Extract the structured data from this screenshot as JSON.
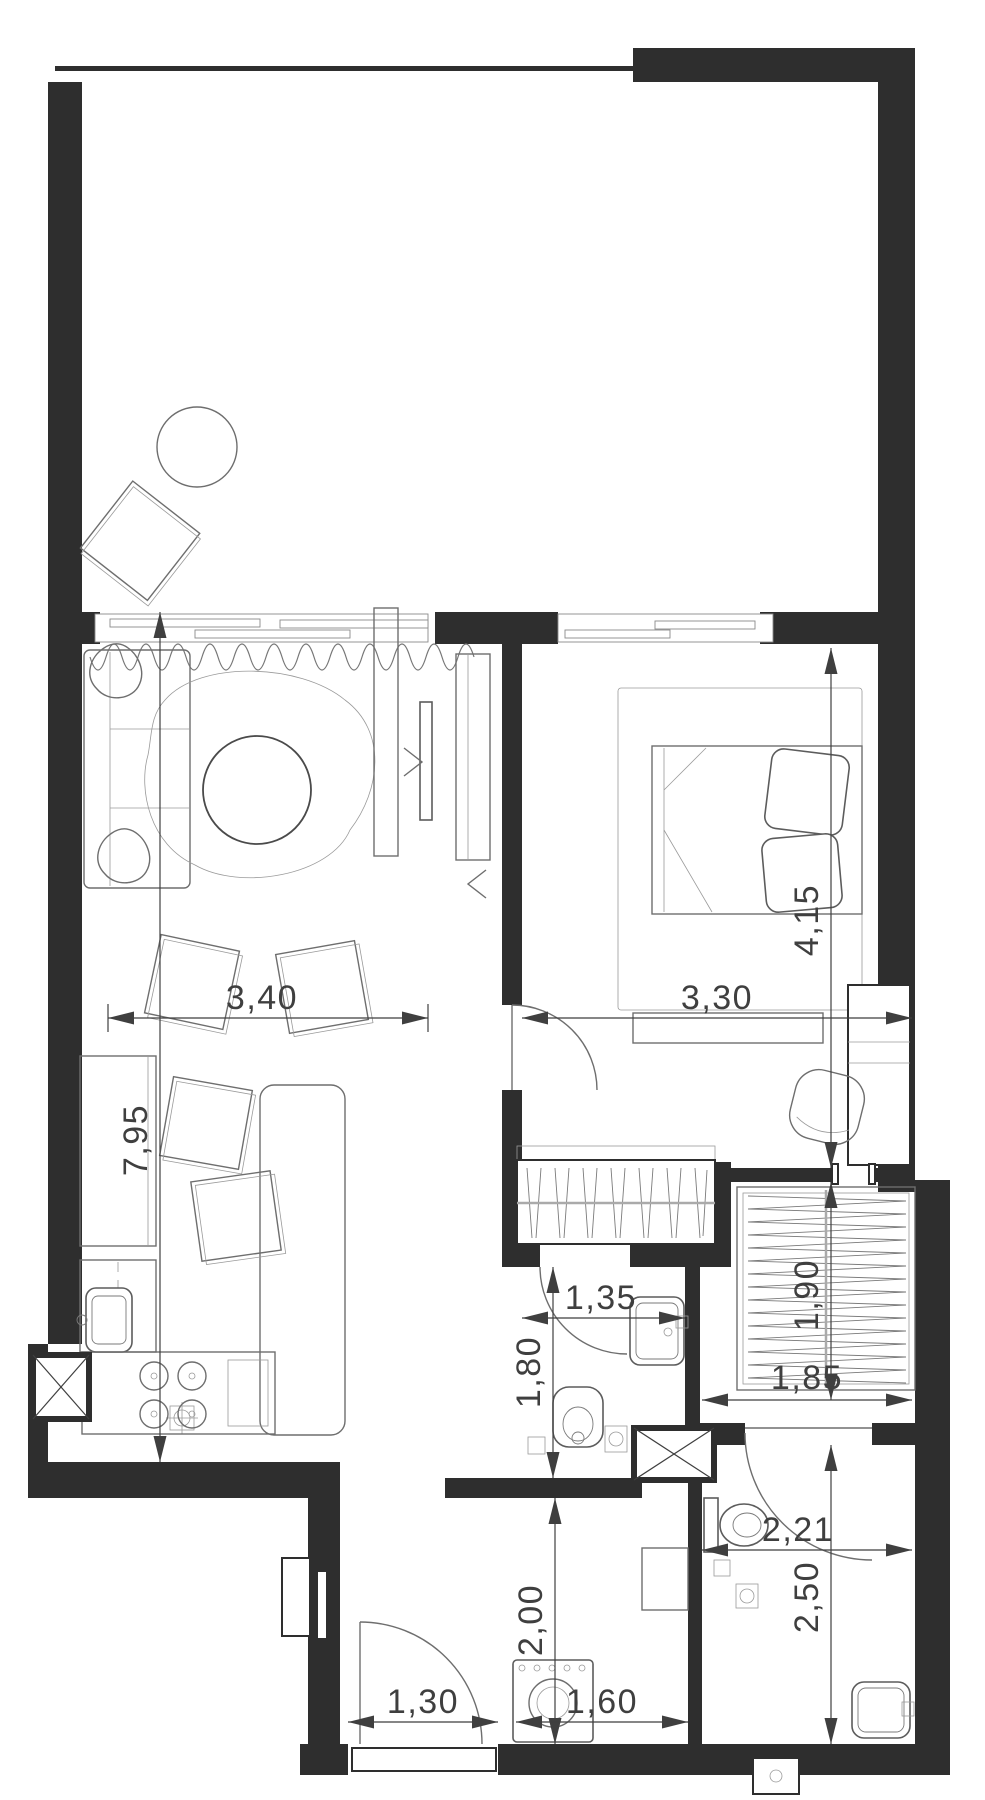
{
  "plan": {
    "type": "apartment-floor-plan",
    "dimensions": {
      "living_width": "3,40",
      "bedroom_width": "3,30",
      "bedroom_depth": "4,15",
      "apartment_depth": "7,95",
      "bath1_width": "1,35",
      "bath1_depth": "1,80",
      "closet_depth": "1,90",
      "closet_width": "1,85",
      "bath2_width": "2,21",
      "bath2_depth": "2,50",
      "hall_depth": "2,00",
      "entry_door_width": "1,30",
      "hall_width": "1,60"
    },
    "colors": {
      "wall": "#2e2e2e",
      "furniture_line": "#6e6e6e",
      "dimension": "#3f3f3f",
      "background": "#ffffff"
    }
  }
}
